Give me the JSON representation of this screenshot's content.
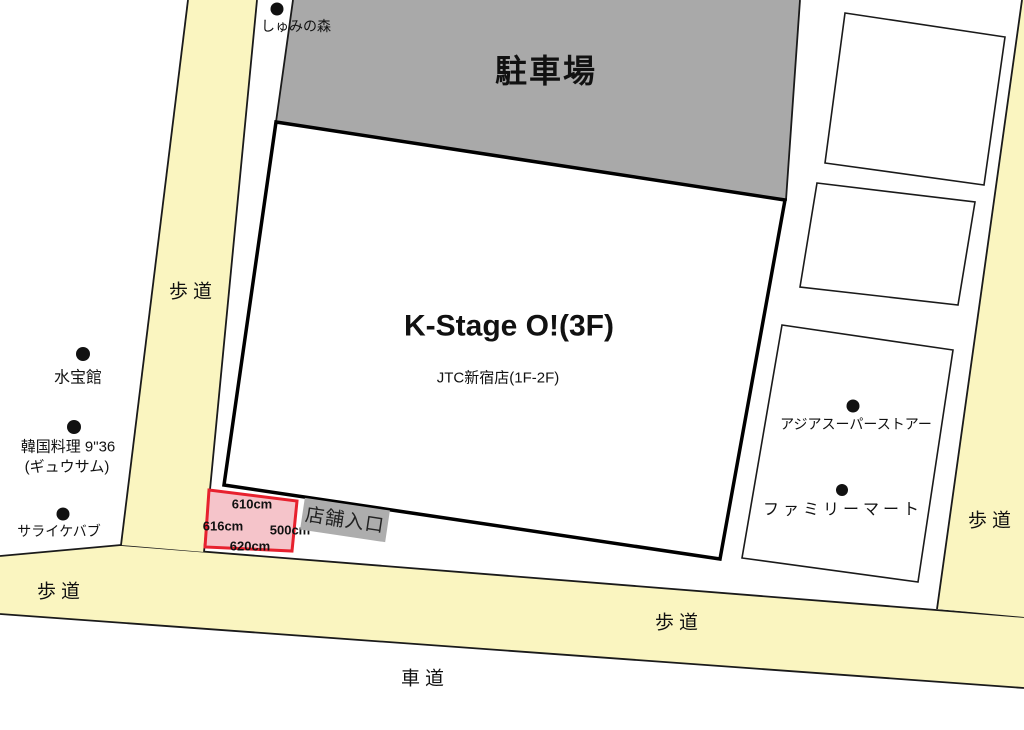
{
  "colors": {
    "sidewalk_yellow": "#FAF5C0",
    "parking_gray": "#A9A9A9",
    "building_white": "#FFFFFF",
    "box_white": "#FFFFFF",
    "measured_area_pink": "#F5C4CA",
    "measured_area_red": "#E7212E",
    "entrance_gray": "#ADADAD",
    "dot_black": "#111111"
  },
  "areas": {
    "parking_label": "駐車場",
    "building_name": "K-Stage O!(3F)",
    "building_floors": "JTC新宿店(1F-2F)",
    "entrance_label": "店舗入口",
    "sidewalk_label": "歩道",
    "roadway_label": "車道"
  },
  "pois": [
    {
      "name": "しゅみの森"
    },
    {
      "name": "水宝館"
    },
    {
      "name": "韓国料理 9\"36",
      "name_sub": "(ギュウサム)"
    },
    {
      "name": "サライケバブ"
    },
    {
      "name": "アジアスーパーストアー"
    },
    {
      "name": "ファミリーマート"
    }
  ],
  "measurements": {
    "top": "610cm",
    "left": "616cm",
    "right": "500cm",
    "bottom": "620cm"
  }
}
